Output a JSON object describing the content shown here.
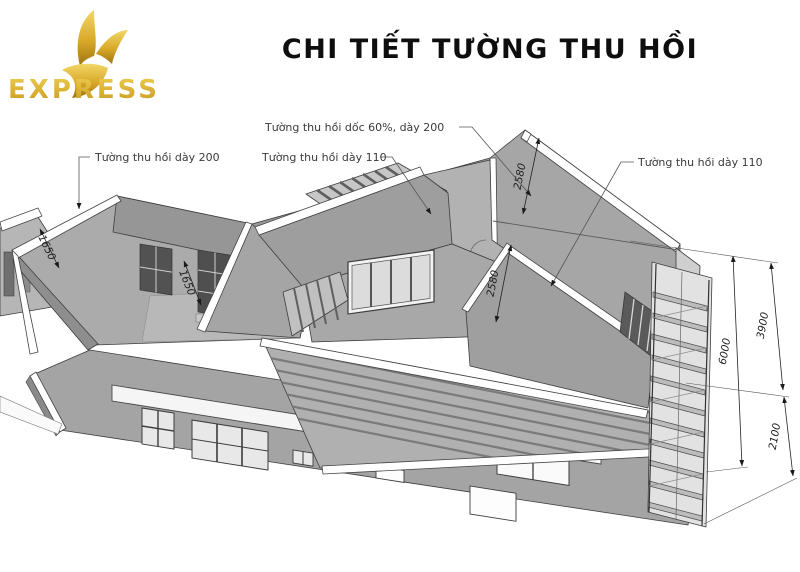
{
  "brand": {
    "name": "EXPRESS",
    "icon": "gold-bird"
  },
  "header": {
    "title": "CHI TIẾT TƯỜNG THU HỒI"
  },
  "labels": {
    "wall200": "Tường thu hồi dày 200",
    "slope60": "Tường thu hồi dốc 60%, dày 200",
    "wall110_mid": "Tường thu hồi dày 110",
    "wall110_right": "Tường thu hồi dày 110"
  },
  "dimensions": {
    "left_slope": "1650",
    "mid_wall": "1650",
    "gable_top": "2580",
    "gable_front": "2580",
    "right_upper": "3900",
    "right_total": "6000",
    "right_lower": "2100"
  },
  "colors": {
    "brand_gold": "#D9A929",
    "wall_gray": "#A4A4A4",
    "line": "#3E3E3E"
  }
}
